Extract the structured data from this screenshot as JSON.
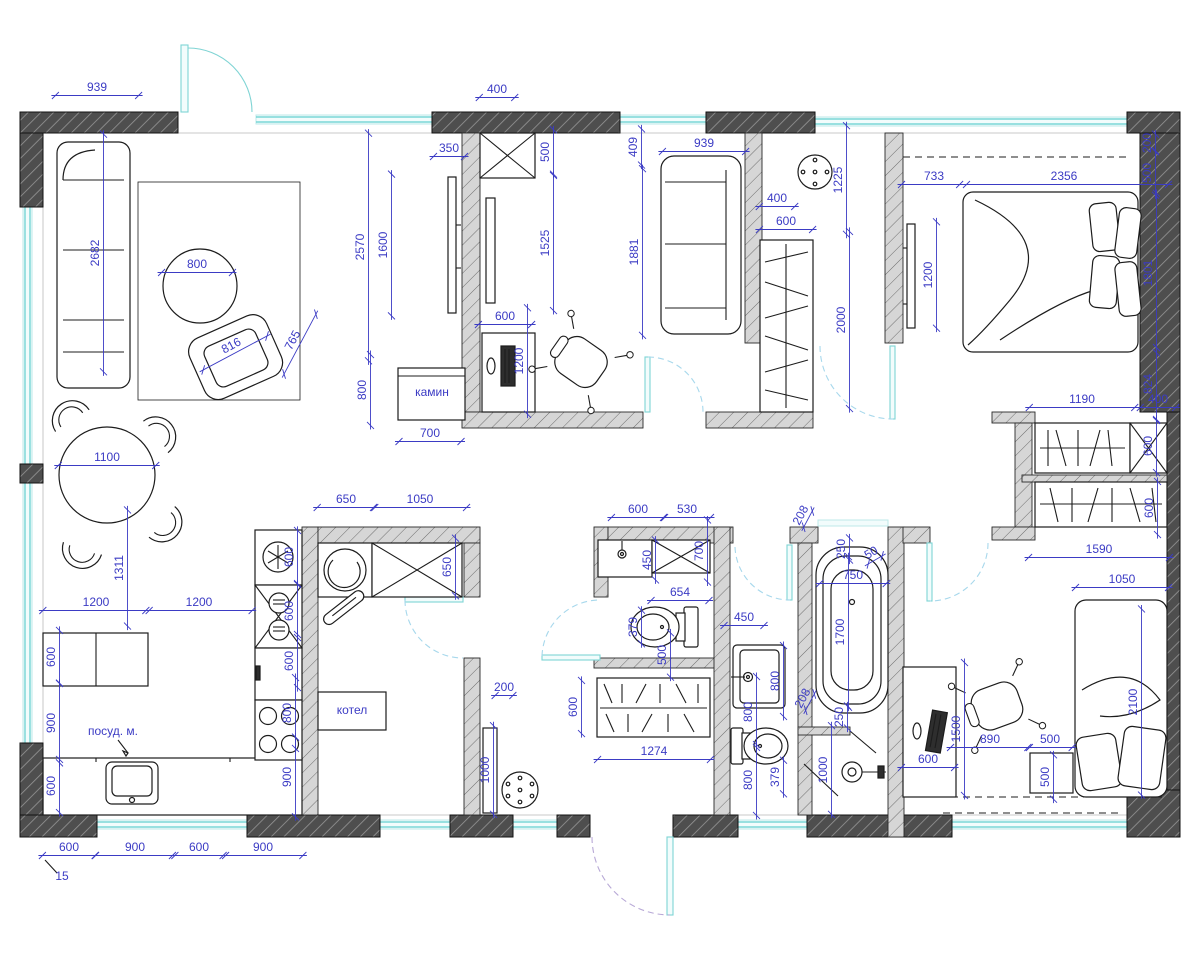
{
  "meta": {
    "title": "Apartment floor plan with furniture and dimensions (mm)",
    "units": "mm"
  },
  "colors": {
    "dimension": "#3b3bc4",
    "wall_dark": "#4e4e4e",
    "wall_light": "#d2d2d2",
    "window": "#62cfcf",
    "door_arc": "#a7d8ec",
    "entry_arc": "#b7a8d6",
    "furniture": "#1c1c1c"
  },
  "room_labels": [
    {
      "text": "камин",
      "meaning": "fireplace"
    },
    {
      "text": "котел",
      "meaning": "boiler"
    },
    {
      "text": "посуд. м.",
      "meaning": "dishwasher"
    }
  ],
  "plan": {
    "scale_px_per_mm": 0.0886,
    "labels": [
      {
        "t": "939",
        "x": 97,
        "y": 91
      },
      {
        "t": "2682",
        "x": 99,
        "y": 253,
        "r": -90
      },
      {
        "t": "800",
        "x": 197,
        "y": 268
      },
      {
        "t": "816",
        "x": 233,
        "y": 349,
        "r": -28
      },
      {
        "t": "765",
        "x": 296,
        "y": 342,
        "r": -62
      },
      {
        "t": "1100",
        "x": 107,
        "y": 461
      },
      {
        "t": "1311",
        "x": 123,
        "y": 568,
        "r": -90
      },
      {
        "t": "1200",
        "x": 96,
        "y": 606
      },
      {
        "t": "1200",
        "x": 199,
        "y": 606
      },
      {
        "t": "600",
        "x": 55,
        "y": 657,
        "r": -90
      },
      {
        "t": "900",
        "x": 55,
        "y": 723,
        "r": -90
      },
      {
        "t": "посуд. м.",
        "x": 113,
        "y": 735,
        "noline": true
      },
      {
        "t": "600",
        "x": 55,
        "y": 786,
        "r": -90
      },
      {
        "t": "600",
        "x": 69,
        "y": 851
      },
      {
        "t": "900",
        "x": 135,
        "y": 851
      },
      {
        "t": "600",
        "x": 199,
        "y": 851
      },
      {
        "t": "900",
        "x": 263,
        "y": 851
      },
      {
        "t": "15",
        "x": 62,
        "y": 880,
        "noline": true
      },
      {
        "t": "600",
        "x": 293,
        "y": 557,
        "r": -90
      },
      {
        "t": "600",
        "x": 293,
        "y": 611,
        "r": -90
      },
      {
        "t": "600",
        "x": 293,
        "y": 661,
        "r": -90
      },
      {
        "t": "800",
        "x": 291,
        "y": 713,
        "r": -90
      },
      {
        "t": "900",
        "x": 291,
        "y": 777,
        "r": -90
      },
      {
        "t": "400",
        "x": 497,
        "y": 93
      },
      {
        "t": "350",
        "x": 449,
        "y": 152
      },
      {
        "t": "500",
        "x": 549,
        "y": 152,
        "r": -90
      },
      {
        "t": "2570",
        "x": 364,
        "y": 247,
        "r": -90
      },
      {
        "t": "1600",
        "x": 387,
        "y": 245,
        "r": -90
      },
      {
        "t": "1525",
        "x": 549,
        "y": 243,
        "r": -90
      },
      {
        "t": "800",
        "x": 366,
        "y": 390,
        "r": -90
      },
      {
        "t": "600",
        "x": 505,
        "y": 320
      },
      {
        "t": "1200",
        "x": 523,
        "y": 361,
        "r": -90
      },
      {
        "t": "камин",
        "x": 432,
        "y": 396,
        "noline": true
      },
      {
        "t": "700",
        "x": 430,
        "y": 437
      },
      {
        "t": "409",
        "x": 637,
        "y": 147,
        "r": -90
      },
      {
        "t": "939",
        "x": 704,
        "y": 147
      },
      {
        "t": "1881",
        "x": 638,
        "y": 252,
        "r": -90
      },
      {
        "t": "400",
        "x": 777,
        "y": 202
      },
      {
        "t": "600",
        "x": 786,
        "y": 225
      },
      {
        "t": "1225",
        "x": 842,
        "y": 180,
        "r": -90
      },
      {
        "t": "2000",
        "x": 845,
        "y": 320,
        "r": -90
      },
      {
        "t": "733",
        "x": 934,
        "y": 180
      },
      {
        "t": "2356",
        "x": 1064,
        "y": 180
      },
      {
        "t": "200",
        "x": 1151,
        "y": 143,
        "r": -90
      },
      {
        "t": "500",
        "x": 1151,
        "y": 173,
        "r": -90
      },
      {
        "t": "1200",
        "x": 932,
        "y": 275,
        "r": -90
      },
      {
        "t": "1801",
        "x": 1152,
        "y": 273,
        "r": -90
      },
      {
        "t": "824",
        "x": 1152,
        "y": 384,
        "r": -90
      },
      {
        "t": "400",
        "x": 1158,
        "y": 403
      },
      {
        "t": "1190",
        "x": 1082,
        "y": 403
      },
      {
        "t": "600",
        "x": 1152,
        "y": 446,
        "r": -90
      },
      {
        "t": "600",
        "x": 1153,
        "y": 508,
        "r": -90
      },
      {
        "t": "1590",
        "x": 1099,
        "y": 553
      },
      {
        "t": "1050",
        "x": 1122,
        "y": 583
      },
      {
        "t": "2100",
        "x": 1137,
        "y": 702,
        "r": -90
      },
      {
        "t": "1500",
        "x": 960,
        "y": 729,
        "r": -90
      },
      {
        "t": "890",
        "x": 990,
        "y": 743
      },
      {
        "t": "500",
        "x": 1050,
        "y": 743
      },
      {
        "t": "500",
        "x": 1049,
        "y": 777,
        "r": -90
      },
      {
        "t": "600",
        "x": 928,
        "y": 763
      },
      {
        "t": "250",
        "x": 845,
        "y": 549,
        "r": -90
      },
      {
        "t": "50",
        "x": 873,
        "y": 556,
        "r": -30
      },
      {
        "t": "750",
        "x": 853,
        "y": 579
      },
      {
        "t": "1700",
        "x": 844,
        "y": 632,
        "r": -90
      },
      {
        "t": "250",
        "x": 843,
        "y": 717,
        "r": -90
      },
      {
        "t": "1000",
        "x": 827,
        "y": 770,
        "r": -90
      },
      {
        "t": "208",
        "x": 804,
        "y": 517,
        "r": -62
      },
      {
        "t": "208",
        "x": 806,
        "y": 700,
        "r": -62
      },
      {
        "t": "600",
        "x": 638,
        "y": 513
      },
      {
        "t": "530",
        "x": 687,
        "y": 513
      },
      {
        "t": "450",
        "x": 651,
        "y": 560,
        "r": -90
      },
      {
        "t": "700",
        "x": 703,
        "y": 551,
        "r": -90
      },
      {
        "t": "654",
        "x": 680,
        "y": 596
      },
      {
        "t": "379",
        "x": 637,
        "y": 627,
        "r": -90
      },
      {
        "t": "500",
        "x": 666,
        "y": 655,
        "r": -90
      },
      {
        "t": "450",
        "x": 744,
        "y": 621
      },
      {
        "t": "800",
        "x": 779,
        "y": 681,
        "r": -90
      },
      {
        "t": "800",
        "x": 752,
        "y": 712,
        "r": -90
      },
      {
        "t": "600",
        "x": 577,
        "y": 707,
        "r": -90
      },
      {
        "t": "1274",
        "x": 654,
        "y": 755
      },
      {
        "t": "800",
        "x": 752,
        "y": 780,
        "r": -90
      },
      {
        "t": "379",
        "x": 779,
        "y": 777,
        "r": -90
      },
      {
        "t": "650",
        "x": 346,
        "y": 503
      },
      {
        "t": "1050",
        "x": 420,
        "y": 503
      },
      {
        "t": "650",
        "x": 451,
        "y": 567,
        "r": -90
      },
      {
        "t": "котел",
        "x": 352,
        "y": 714,
        "noline": true
      },
      {
        "t": "200",
        "x": 504,
        "y": 691
      },
      {
        "t": "1000",
        "x": 489,
        "y": 770,
        "r": -90
      }
    ]
  }
}
